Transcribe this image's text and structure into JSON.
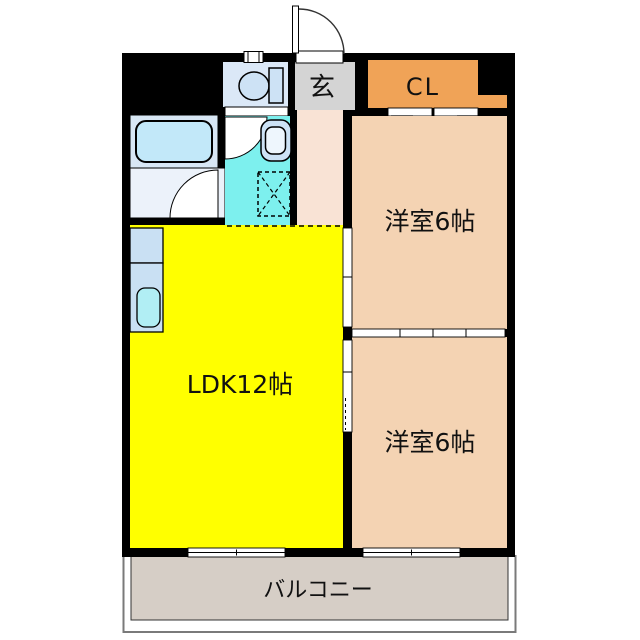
{
  "plan": {
    "rooms": {
      "genkan": {
        "label": "玄"
      },
      "closet": {
        "label": "CL"
      },
      "bedroom_upper": {
        "label": "洋室6帖"
      },
      "bedroom_lower": {
        "label": "洋室6帖"
      },
      "ldk": {
        "label": "LDK12帖"
      },
      "balcony": {
        "label": "バルコニー"
      }
    },
    "icons": [
      "bathtub-icon",
      "toilet-icon",
      "washbasin-icon",
      "washing-machine-space-icon",
      "kitchen-counter-icon",
      "kitchen-sink-icon",
      "entrance-door-icon",
      "bath-door-icon",
      "washroom-door-icon",
      "closet-folding-door-icon",
      "sliding-door-icon",
      "window-icon"
    ]
  },
  "colors": {
    "wall": "#000000",
    "ldk": "#ffff00",
    "bedroom": "#f4d3b3",
    "closet": "#f0a357",
    "genkan": "#d4d4d4",
    "hall": "#f9e3d5",
    "washroom": "#7df0ee",
    "toilet_room": "#dbe8f7",
    "bath": "#d8e7f5",
    "bath_floor": "#ecf2fa",
    "tub": "#c2e8f9",
    "fixture": "#cde2f5",
    "counter": "#c9e0f3",
    "sink": "#b1eef4",
    "balcony": "#d6cec6",
    "background": "#ffffff"
  }
}
